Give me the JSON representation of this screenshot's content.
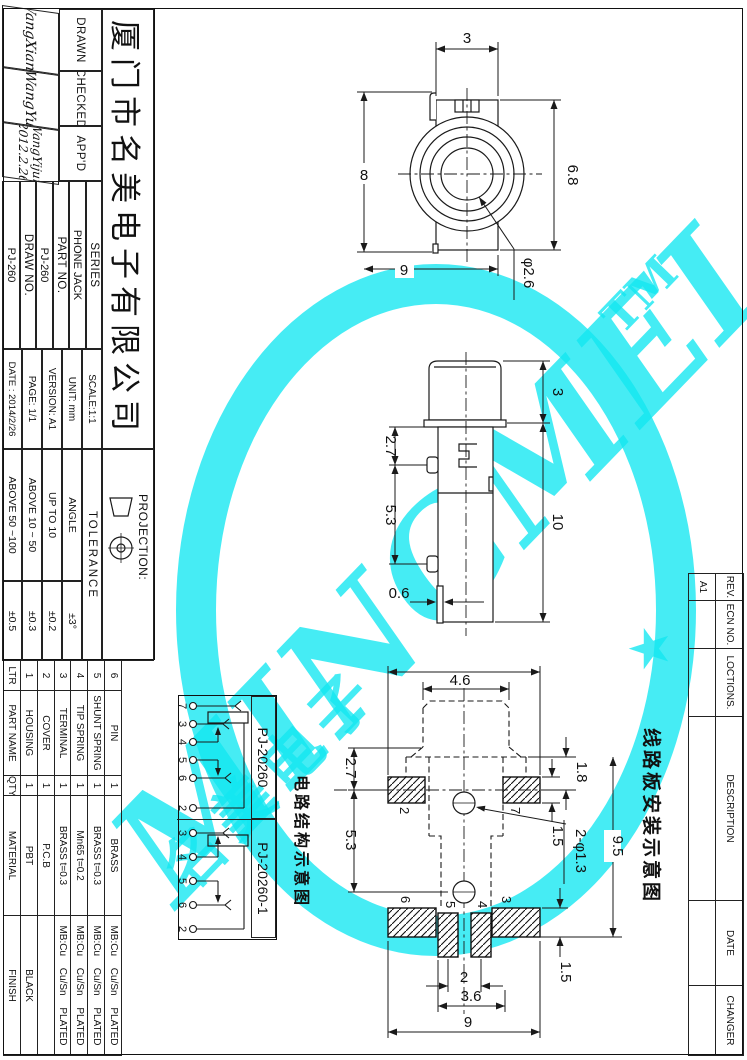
{
  "watermark": {
    "brand": "MINGMEI",
    "tm": "TM",
    "cn": "名美电子",
    "star": "★",
    "color": "#12E7F1"
  },
  "title_block": {
    "company": "厦门市名美电子有限公司",
    "drawn_label": "DRAWN",
    "drawn_value": "WangXiang",
    "checked_label": "CHECKED",
    "checked_value": "WangYu",
    "appd_label": "APP'D",
    "appd_value": "WangYijun",
    "appd_date": "2012.2.26",
    "series_label": "SERIES",
    "series_value": "PHONE JACK",
    "part_no_label": "PART  NO.",
    "part_no_value": "PJ-260",
    "draw_no_label": "DRAW  NO.",
    "draw_no_value": "PJ-260",
    "scale": "SCALE:1:1",
    "unit": "UNIT: mm",
    "version": "VERSION: A1",
    "page": "PAGE:  1/1",
    "date": "DATE : 2014/2/26",
    "projection_label": "PROJECTION:"
  },
  "tolerance": {
    "title": "TOLERANCE",
    "rows": [
      [
        "ANGLE",
        "±3°"
      ],
      [
        "UP TO 10",
        "±0.2"
      ],
      [
        "ABOVE 10 ~ 50",
        "±0.3"
      ],
      [
        "ABOVE 50 ~100",
        "±0.5"
      ]
    ]
  },
  "bom": {
    "headers": [
      "LTR",
      "PART NAME",
      "QTY",
      "MATERIAL",
      "FINISH"
    ],
    "rows": [
      [
        "6",
        "PIN",
        "1",
        "BRASS",
        "MB:Cu Cu/Sn PLATED"
      ],
      [
        "5",
        "SHUNT SPRING",
        "1",
        "BRASS t=0.3",
        "MB:Cu Cu/Sn PLATED"
      ],
      [
        "4",
        "TIP SPRING",
        "1",
        "Mn65 t=0.2",
        "MB:Cu Cu/Sn PLATED"
      ],
      [
        "3",
        "TERMINAL",
        "1",
        "BRASS t=0.3",
        "MB:Cu Cu/Sn PLATED"
      ],
      [
        "2",
        "COVER",
        "1",
        "P.C.B",
        ""
      ],
      [
        "1",
        "HOUSING",
        "1",
        "PBT",
        "BLACK"
      ]
    ]
  },
  "revision": {
    "headers": [
      "REV.",
      "ECN NO.",
      "LOCTIONS.",
      "DESCRIPTION",
      "DATE",
      "CHANGER"
    ],
    "values": [
      "A1",
      "",
      "",
      "",
      "",
      ""
    ]
  },
  "schematic": {
    "title": "电路结构示意图",
    "variants": [
      {
        "name": "PJ-20260",
        "pins": [
          "7",
          "3",
          "4",
          "5",
          "6",
          "2"
        ]
      },
      {
        "name": "PJ-20260-1",
        "pins": [
          "3",
          "4",
          "5",
          "6",
          "2"
        ]
      }
    ]
  },
  "pcb_view_label": "线路板安装示意图",
  "dims": {
    "front": {
      "top": "3",
      "right": "6.8",
      "left": "8",
      "bottom": "9",
      "hole": "φ2.6"
    },
    "side": {
      "cap": "3",
      "body": "10",
      "upper": "2.7",
      "lower": "5.3",
      "pin": "0.6"
    },
    "pcb": {
      "head": "4.6",
      "left_upper": "2.7",
      "left_lower": "5.3",
      "pad_left": "2",
      "pad_right": "7",
      "right_1": "1.8",
      "right_2": "1.5",
      "height": "9.5",
      "holes": "2-φ1.3",
      "pads": [
        "6",
        "5",
        "4",
        "3"
      ],
      "gap": "2",
      "width_mid": "3.6",
      "width": "9",
      "right_3": "1.5"
    }
  }
}
